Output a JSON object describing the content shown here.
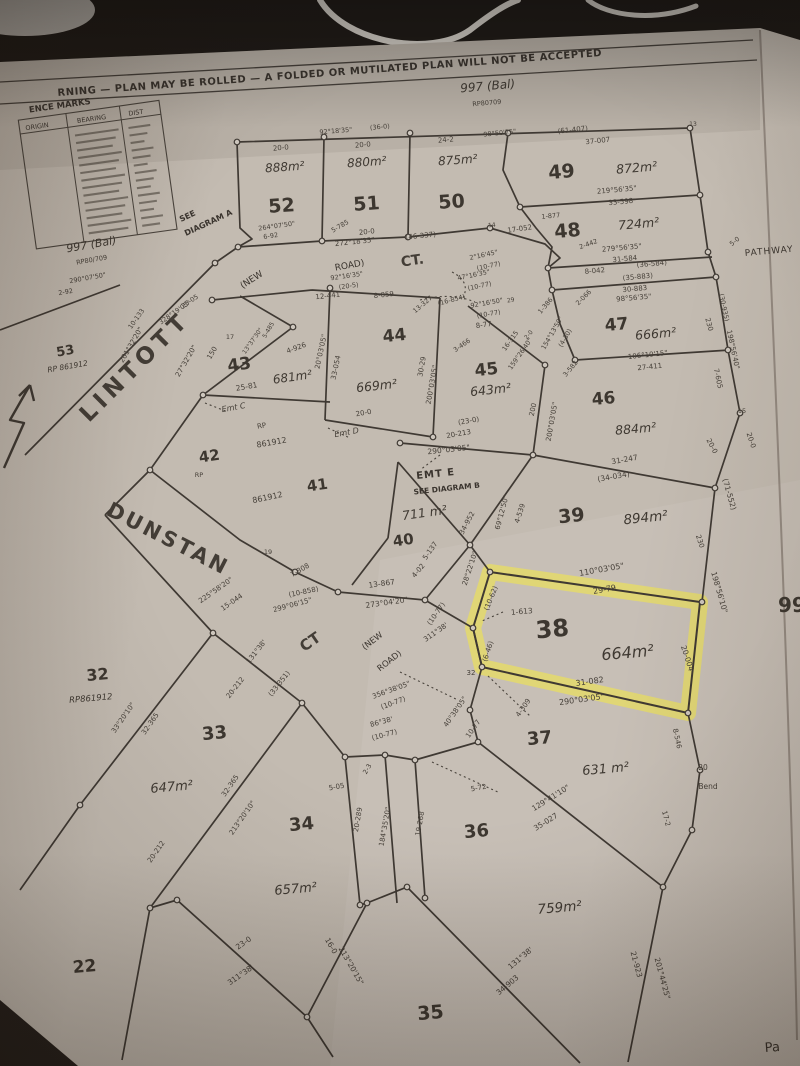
{
  "document": {
    "warning": "RNING  —  PLAN MAY BE ROLLED  —  A FOLDED OR MUTILATED PLAN WILL NOT BE ACCEPTED",
    "balance_lot_top": "997 (Bal)",
    "balance_rp_top": "RP80709",
    "balance_lot_left": "997 (Bal)",
    "balance_rp_left": "RP80/709",
    "see_diagram_a_line1": "SEE",
    "see_diagram_a_line2": "DIAGRAM A",
    "right_edge_text": "99",
    "bottom_right_text": "Pa"
  },
  "reference_marks": {
    "title": "ENCE MARKS",
    "columns": [
      "ORIGIN",
      "BEARING",
      "DIST"
    ],
    "rows_illegible": true
  },
  "roads": {
    "lintott": "LINTOTT",
    "dunstan": "DUNSTAN",
    "dunstan_ct": "CT",
    "top_ct": "CT.",
    "new_road_top_1": "(NEW",
    "new_road_top_2": "ROAD)",
    "new_road_dunstan_1": "(NEW",
    "new_road_dunstan_2": "ROAD)",
    "pathway": "PATHWAY",
    "emt_e": "EMT E",
    "emt_e_note": "SEE DIAGRAM B"
  },
  "highlight": {
    "lot": "38",
    "color": "#e8dd60"
  },
  "lots": [
    {
      "number": "52",
      "area": "888m²"
    },
    {
      "number": "51",
      "area": "880m²"
    },
    {
      "number": "50",
      "area": "875m²"
    },
    {
      "number": "49",
      "area": "872m²"
    },
    {
      "number": "48",
      "area": "724m²"
    },
    {
      "number": "47",
      "area": "666m²"
    },
    {
      "number": "46",
      "area": "884m²"
    },
    {
      "number": "45",
      "area": "643m²"
    },
    {
      "number": "44",
      "area": "669m²"
    },
    {
      "number": "43",
      "area": "681m²"
    },
    {
      "number": "42"
    },
    {
      "number": "41"
    },
    {
      "number": "40",
      "area": "711 m²"
    },
    {
      "number": "39",
      "area": "894m²"
    },
    {
      "number": "38",
      "area": "664m²"
    },
    {
      "number": "37",
      "area": "631 m²"
    },
    {
      "number": "36",
      "area": "759m²"
    },
    {
      "number": "35"
    },
    {
      "number": "34",
      "area": "657m²"
    },
    {
      "number": "33",
      "area": "647m²"
    },
    {
      "number": "32",
      "rp": "RP861912"
    },
    {
      "number": "22"
    },
    {
      "number": "53",
      "rp": "RP 861912"
    }
  ],
  "measurements": [
    {
      "t": "20-0",
      "x": 281,
      "y": 150,
      "r": -5,
      "s": 7
    },
    {
      "t": "92°18'35\"",
      "x": 336,
      "y": 133,
      "r": -5,
      "s": 6.5
    },
    {
      "t": "(36-0)",
      "x": 380,
      "y": 129,
      "r": -5,
      "s": 6.5
    },
    {
      "t": "20-0",
      "x": 363,
      "y": 147,
      "r": -5,
      "s": 7
    },
    {
      "t": "24-2",
      "x": 446,
      "y": 142,
      "r": -5,
      "s": 7
    },
    {
      "t": "98°50'25\"",
      "x": 500,
      "y": 135,
      "r": -6,
      "s": 6.5
    },
    {
      "t": "(61-407)",
      "x": 573,
      "y": 132,
      "r": -6,
      "s": 7
    },
    {
      "t": "37-007",
      "x": 598,
      "y": 143,
      "r": -6,
      "s": 7
    },
    {
      "t": "13",
      "x": 693,
      "y": 126,
      "r": 0,
      "s": 6
    },
    {
      "t": "219°56'35\"",
      "x": 617,
      "y": 192,
      "r": -5,
      "s": 7
    },
    {
      "t": "33-598",
      "x": 621,
      "y": 204,
      "r": -5,
      "s": 7
    },
    {
      "t": "1-877",
      "x": 551,
      "y": 218,
      "r": -5,
      "s": 6.5
    },
    {
      "t": "2-442",
      "x": 589,
      "y": 246,
      "r": -20,
      "s": 6.5
    },
    {
      "t": "279°56'35\"",
      "x": 622,
      "y": 250,
      "r": -5,
      "s": 7
    },
    {
      "t": "31-584",
      "x": 625,
      "y": 261,
      "r": -5,
      "s": 7
    },
    {
      "t": "8-042",
      "x": 595,
      "y": 273,
      "r": -5,
      "s": 7
    },
    {
      "t": "(36-584)",
      "x": 652,
      "y": 266,
      "r": -5,
      "s": 7
    },
    {
      "t": "(35-883)",
      "x": 638,
      "y": 279,
      "r": -5,
      "s": 7
    },
    {
      "t": "30-883",
      "x": 635,
      "y": 291,
      "r": -5,
      "s": 7
    },
    {
      "t": "98°56'35\"",
      "x": 634,
      "y": 300,
      "r": -5,
      "s": 7
    },
    {
      "t": "5-0",
      "x": 736,
      "y": 243,
      "r": -40,
      "s": 6.5
    },
    {
      "t": "264°07'50\"",
      "x": 277,
      "y": 228,
      "r": -8,
      "s": 6.5
    },
    {
      "t": "6-92",
      "x": 271,
      "y": 238,
      "r": -8,
      "s": 6.5
    },
    {
      "t": "5-785",
      "x": 341,
      "y": 228,
      "r": -30,
      "s": 6.5
    },
    {
      "t": "20-0",
      "x": 367,
      "y": 234,
      "r": -6,
      "s": 7
    },
    {
      "t": "272°18'35\"",
      "x": 355,
      "y": 244,
      "r": -6,
      "s": 7
    },
    {
      "t": "(46-337)",
      "x": 421,
      "y": 238,
      "r": -6,
      "s": 7
    },
    {
      "t": "14",
      "x": 492,
      "y": 227,
      "r": -6,
      "s": 6
    },
    {
      "t": "17-052",
      "x": 520,
      "y": 231,
      "r": -8,
      "s": 7
    },
    {
      "t": "92°16'35\"",
      "x": 347,
      "y": 278,
      "r": -8,
      "s": 6.5
    },
    {
      "t": "(20-5)",
      "x": 349,
      "y": 288,
      "r": -8,
      "s": 6.5
    },
    {
      "t": "12-441",
      "x": 328,
      "y": 298,
      "r": -6,
      "s": 7
    },
    {
      "t": "8-059",
      "x": 384,
      "y": 297,
      "r": -6,
      "s": 7
    },
    {
      "t": "13-327",
      "x": 424,
      "y": 306,
      "r": -40,
      "s": 6.5
    },
    {
      "t": "(16-854)",
      "x": 452,
      "y": 302,
      "r": -15,
      "s": 6.5
    },
    {
      "t": "92°16'50\"",
      "x": 487,
      "y": 305,
      "r": -10,
      "s": 6.5
    },
    {
      "t": "29",
      "x": 511,
      "y": 302,
      "r": -10,
      "s": 6
    },
    {
      "t": "(10-77)",
      "x": 489,
      "y": 316,
      "r": -10,
      "s": 6.5
    },
    {
      "t": "8-77",
      "x": 484,
      "y": 327,
      "r": -8,
      "s": 7
    },
    {
      "t": "3-466",
      "x": 463,
      "y": 347,
      "r": -35,
      "s": 6.5
    },
    {
      "t": "2°16'45\"",
      "x": 484,
      "y": 257,
      "r": -12,
      "s": 6.5
    },
    {
      "t": "(10-77)",
      "x": 489,
      "y": 268,
      "r": -12,
      "s": 6.5
    },
    {
      "t": "47°16'35\"",
      "x": 474,
      "y": 277,
      "r": -12,
      "s": 6.5
    },
    {
      "t": "(10-77)",
      "x": 480,
      "y": 288,
      "r": -12,
      "s": 6.5
    },
    {
      "t": "17",
      "x": 230,
      "y": 339,
      "r": 0,
      "s": 6.5
    },
    {
      "t": "150",
      "x": 214,
      "y": 354,
      "r": -60,
      "s": 7
    },
    {
      "t": "27°32'20\"",
      "x": 188,
      "y": 362,
      "r": -60,
      "s": 7
    },
    {
      "t": "10-133",
      "x": 138,
      "y": 320,
      "r": -55,
      "s": 6.5
    },
    {
      "t": "201°32'20\"",
      "x": 133,
      "y": 346,
      "r": -60,
      "s": 7
    },
    {
      "t": "328°19'05\"",
      "x": 176,
      "y": 314,
      "r": -35,
      "s": 6.5
    },
    {
      "t": "25-05",
      "x": 191,
      "y": 303,
      "r": -35,
      "s": 6.5
    },
    {
      "t": "13°37'30\"",
      "x": 254,
      "y": 342,
      "r": -55,
      "s": 6
    },
    {
      "t": "5-485",
      "x": 270,
      "y": 331,
      "r": -60,
      "s": 6
    },
    {
      "t": "4-926",
      "x": 297,
      "y": 350,
      "r": -20,
      "s": 7
    },
    {
      "t": "25-81",
      "x": 247,
      "y": 389,
      "r": -10,
      "s": 7.5
    },
    {
      "t": "Emt C",
      "x": 234,
      "y": 410,
      "r": -10,
      "s": 8,
      "i": 1
    },
    {
      "t": "RP",
      "x": 262,
      "y": 428,
      "r": -10,
      "s": 7
    },
    {
      "t": "861912",
      "x": 272,
      "y": 445,
      "r": -10,
      "s": 8
    },
    {
      "t": "290°07'50\"",
      "x": 88,
      "y": 280,
      "r": -10,
      "s": 6.5
    },
    {
      "t": "2-92",
      "x": 66,
      "y": 294,
      "r": -10,
      "s": 6.5
    },
    {
      "t": "20°03'05\"",
      "x": 323,
      "y": 352,
      "r": -78,
      "s": 7
    },
    {
      "t": "33-054",
      "x": 338,
      "y": 368,
      "r": -78,
      "s": 7
    },
    {
      "t": "20-0",
      "x": 364,
      "y": 415,
      "r": -10,
      "s": 7
    },
    {
      "t": "Emt D",
      "x": 347,
      "y": 435,
      "r": -10,
      "s": 8,
      "i": 1
    },
    {
      "t": "861912",
      "x": 268,
      "y": 500,
      "r": -12,
      "s": 8
    },
    {
      "t": "RP",
      "x": 199,
      "y": 477,
      "r": 0,
      "s": 6.5
    },
    {
      "t": "30-29",
      "x": 424,
      "y": 367,
      "r": -80,
      "s": 7
    },
    {
      "t": "200°03'05\"",
      "x": 434,
      "y": 385,
      "r": -80,
      "s": 7
    },
    {
      "t": "16-315",
      "x": 512,
      "y": 342,
      "r": -55,
      "s": 6.5
    },
    {
      "t": "159°26'40\"",
      "x": 522,
      "y": 355,
      "r": -55,
      "s": 6.5
    },
    {
      "t": "2-0",
      "x": 530,
      "y": 336,
      "r": -50,
      "s": 6
    },
    {
      "t": "200",
      "x": 535,
      "y": 410,
      "r": -78,
      "s": 7
    },
    {
      "t": "200°03'05\"",
      "x": 554,
      "y": 422,
      "r": -80,
      "s": 7
    },
    {
      "t": "(23-0)",
      "x": 469,
      "y": 423,
      "r": -10,
      "s": 7
    },
    {
      "t": "20-213",
      "x": 459,
      "y": 436,
      "r": -10,
      "s": 7
    },
    {
      "t": "106°10'15\"",
      "x": 648,
      "y": 357,
      "r": -6,
      "s": 7
    },
    {
      "t": "27-411",
      "x": 650,
      "y": 369,
      "r": -6,
      "s": 7
    },
    {
      "t": "1-386",
      "x": 547,
      "y": 307,
      "r": -50,
      "s": 6.5
    },
    {
      "t": "2-066",
      "x": 585,
      "y": 299,
      "r": -45,
      "s": 6.5
    },
    {
      "t": "154°13'50\"",
      "x": 554,
      "y": 334,
      "r": -60,
      "s": 6.5
    },
    {
      "t": "(4-30)",
      "x": 567,
      "y": 339,
      "r": -60,
      "s": 6.5
    },
    {
      "t": "3-582",
      "x": 572,
      "y": 370,
      "r": -50,
      "s": 6.5
    },
    {
      "t": "230",
      "x": 707,
      "y": 325,
      "r": 75,
      "s": 7
    },
    {
      "t": "(30-935)",
      "x": 722,
      "y": 308,
      "r": 78,
      "s": 6.5
    },
    {
      "t": "198°56'40\"",
      "x": 731,
      "y": 350,
      "r": 78,
      "s": 7
    },
    {
      "t": "7-605",
      "x": 716,
      "y": 379,
      "r": 78,
      "s": 7
    },
    {
      "t": "15",
      "x": 742,
      "y": 413,
      "r": 0,
      "s": 6.5
    },
    {
      "t": "20-0",
      "x": 749,
      "y": 441,
      "r": 72,
      "s": 7
    },
    {
      "t": "31-247",
      "x": 625,
      "y": 462,
      "r": -10,
      "s": 7.5
    },
    {
      "t": "(34-034)",
      "x": 614,
      "y": 479,
      "r": -10,
      "s": 7.5
    },
    {
      "t": "290°03'05\"",
      "x": 449,
      "y": 452,
      "r": -6,
      "s": 7.5
    },
    {
      "t": "34-952",
      "x": 469,
      "y": 524,
      "r": -62,
      "s": 7
    },
    {
      "t": "5-137",
      "x": 432,
      "y": 552,
      "r": -55,
      "s": 7
    },
    {
      "t": "4-02",
      "x": 420,
      "y": 572,
      "r": -50,
      "s": 7
    },
    {
      "t": "69°12'50\"",
      "x": 504,
      "y": 513,
      "r": -75,
      "s": 7
    },
    {
      "t": "4-539",
      "x": 522,
      "y": 514,
      "r": -72,
      "s": 7
    },
    {
      "t": "230",
      "x": 698,
      "y": 542,
      "r": 72,
      "s": 7
    },
    {
      "t": "(71-552)",
      "x": 727,
      "y": 495,
      "r": 74,
      "s": 7.5
    },
    {
      "t": "198°56'10\"",
      "x": 717,
      "y": 593,
      "r": 74,
      "s": 7.5
    },
    {
      "t": "20-0",
      "x": 710,
      "y": 447,
      "r": 62,
      "s": 7
    },
    {
      "t": "19",
      "x": 268,
      "y": 554,
      "r": 0,
      "s": 6.5
    },
    {
      "t": "7-308",
      "x": 301,
      "y": 572,
      "r": -30,
      "s": 7
    },
    {
      "t": "(10-858)",
      "x": 304,
      "y": 594,
      "r": -12,
      "s": 7
    },
    {
      "t": "225°58'20\"",
      "x": 217,
      "y": 592,
      "r": -35,
      "s": 7
    },
    {
      "t": "15-044",
      "x": 233,
      "y": 604,
      "r": -35,
      "s": 7
    },
    {
      "t": "299°06'15\"",
      "x": 293,
      "y": 607,
      "r": -15,
      "s": 7
    },
    {
      "t": "13-867",
      "x": 382,
      "y": 586,
      "r": -8,
      "s": 7.5
    },
    {
      "t": "273°04'20\"",
      "x": 387,
      "y": 605,
      "r": -8,
      "s": 7.5
    },
    {
      "t": "(10-77)",
      "x": 438,
      "y": 615,
      "r": -55,
      "s": 7
    },
    {
      "t": "311°38'",
      "x": 437,
      "y": 634,
      "r": -35,
      "s": 7
    },
    {
      "t": "356°38'05\"",
      "x": 392,
      "y": 692,
      "r": -20,
      "s": 7
    },
    {
      "t": "(10-77)",
      "x": 394,
      "y": 705,
      "r": -20,
      "s": 7
    },
    {
      "t": "86°38'",
      "x": 382,
      "y": 724,
      "r": -15,
      "s": 7
    },
    {
      "t": "(10-77)",
      "x": 385,
      "y": 737,
      "r": -15,
      "s": 7
    },
    {
      "t": "110°03'05\"",
      "x": 602,
      "y": 572,
      "r": -10,
      "s": 8
    },
    {
      "t": "29-79",
      "x": 605,
      "y": 592,
      "r": -10,
      "s": 8
    },
    {
      "t": "1-613",
      "x": 522,
      "y": 614,
      "r": -5,
      "s": 7.5
    },
    {
      "t": "(10-62)",
      "x": 493,
      "y": 599,
      "r": -68,
      "s": 7
    },
    {
      "t": "(6-46)",
      "x": 490,
      "y": 652,
      "r": -72,
      "s": 7
    },
    {
      "t": "28°22'10\"",
      "x": 472,
      "y": 569,
      "r": -72,
      "s": 7
    },
    {
      "t": "32",
      "x": 471,
      "y": 675,
      "r": 0,
      "s": 7
    },
    {
      "t": "31-082",
      "x": 590,
      "y": 684,
      "r": -8,
      "s": 8
    },
    {
      "t": "290°03'05\"",
      "x": 582,
      "y": 702,
      "r": -8,
      "s": 8
    },
    {
      "t": "20-004",
      "x": 685,
      "y": 659,
      "r": 72,
      "s": 7.5
    },
    {
      "t": "129°41'10\"",
      "x": 552,
      "y": 800,
      "r": -32,
      "s": 7.5
    },
    {
      "t": "35-027",
      "x": 547,
      "y": 824,
      "r": -32,
      "s": 7.5
    },
    {
      "t": "8-546",
      "x": 675,
      "y": 739,
      "r": 78,
      "s": 7
    },
    {
      "t": "20",
      "x": 703,
      "y": 770,
      "r": 0,
      "s": 7.5
    },
    {
      "t": "Bend",
      "x": 708,
      "y": 789,
      "r": 0,
      "s": 7.5
    },
    {
      "t": "17-2",
      "x": 664,
      "y": 819,
      "r": 75,
      "s": 7
    },
    {
      "t": "4-309",
      "x": 525,
      "y": 709,
      "r": -55,
      "s": 7
    },
    {
      "t": "40°38'05\"",
      "x": 457,
      "y": 713,
      "r": -55,
      "s": 7
    },
    {
      "t": "10-77",
      "x": 475,
      "y": 730,
      "r": -55,
      "s": 7
    },
    {
      "t": "5-72",
      "x": 479,
      "y": 790,
      "r": -10,
      "s": 7
    },
    {
      "t": "131°38'",
      "x": 522,
      "y": 960,
      "r": -40,
      "s": 7.5
    },
    {
      "t": "34-903",
      "x": 509,
      "y": 987,
      "r": -40,
      "s": 7.5
    },
    {
      "t": "21-923",
      "x": 634,
      "y": 965,
      "r": 75,
      "s": 7.5
    },
    {
      "t": "201°44'25\"",
      "x": 660,
      "y": 979,
      "r": 75,
      "s": 7.5
    },
    {
      "t": "5-05",
      "x": 337,
      "y": 789,
      "r": -10,
      "s": 7
    },
    {
      "t": "2-3",
      "x": 369,
      "y": 770,
      "r": -60,
      "s": 6.5
    },
    {
      "t": "20-289",
      "x": 360,
      "y": 820,
      "r": -80,
      "s": 7
    },
    {
      "t": "184°35'20\"",
      "x": 387,
      "y": 827,
      "r": -80,
      "s": 7
    },
    {
      "t": "19-268",
      "x": 422,
      "y": 824,
      "r": -80,
      "s": 7
    },
    {
      "t": "33°20'10\"",
      "x": 125,
      "y": 719,
      "r": -55,
      "s": 7
    },
    {
      "t": "32-365",
      "x": 152,
      "y": 725,
      "r": -55,
      "s": 7
    },
    {
      "t": "32-365",
      "x": 232,
      "y": 787,
      "r": -55,
      "s": 7
    },
    {
      "t": "213°20'10\"",
      "x": 244,
      "y": 819,
      "r": -55,
      "s": 7
    },
    {
      "t": "131°38'",
      "x": 258,
      "y": 653,
      "r": -52,
      "s": 7
    },
    {
      "t": "(33-351)",
      "x": 281,
      "y": 685,
      "r": -52,
      "s": 7
    },
    {
      "t": "20-212",
      "x": 237,
      "y": 689,
      "r": -52,
      "s": 7
    },
    {
      "t": "20-212",
      "x": 158,
      "y": 853,
      "r": -55,
      "s": 7
    },
    {
      "t": "23-0",
      "x": 245,
      "y": 945,
      "r": -35,
      "s": 7.5
    },
    {
      "t": "311°38'",
      "x": 242,
      "y": 977,
      "r": -35,
      "s": 7.5
    },
    {
      "t": "16-0",
      "x": 329,
      "y": 947,
      "r": 60,
      "s": 7.5
    },
    {
      "t": "213°20'15\"",
      "x": 349,
      "y": 967,
      "r": 60,
      "s": 7.5
    }
  ]
}
